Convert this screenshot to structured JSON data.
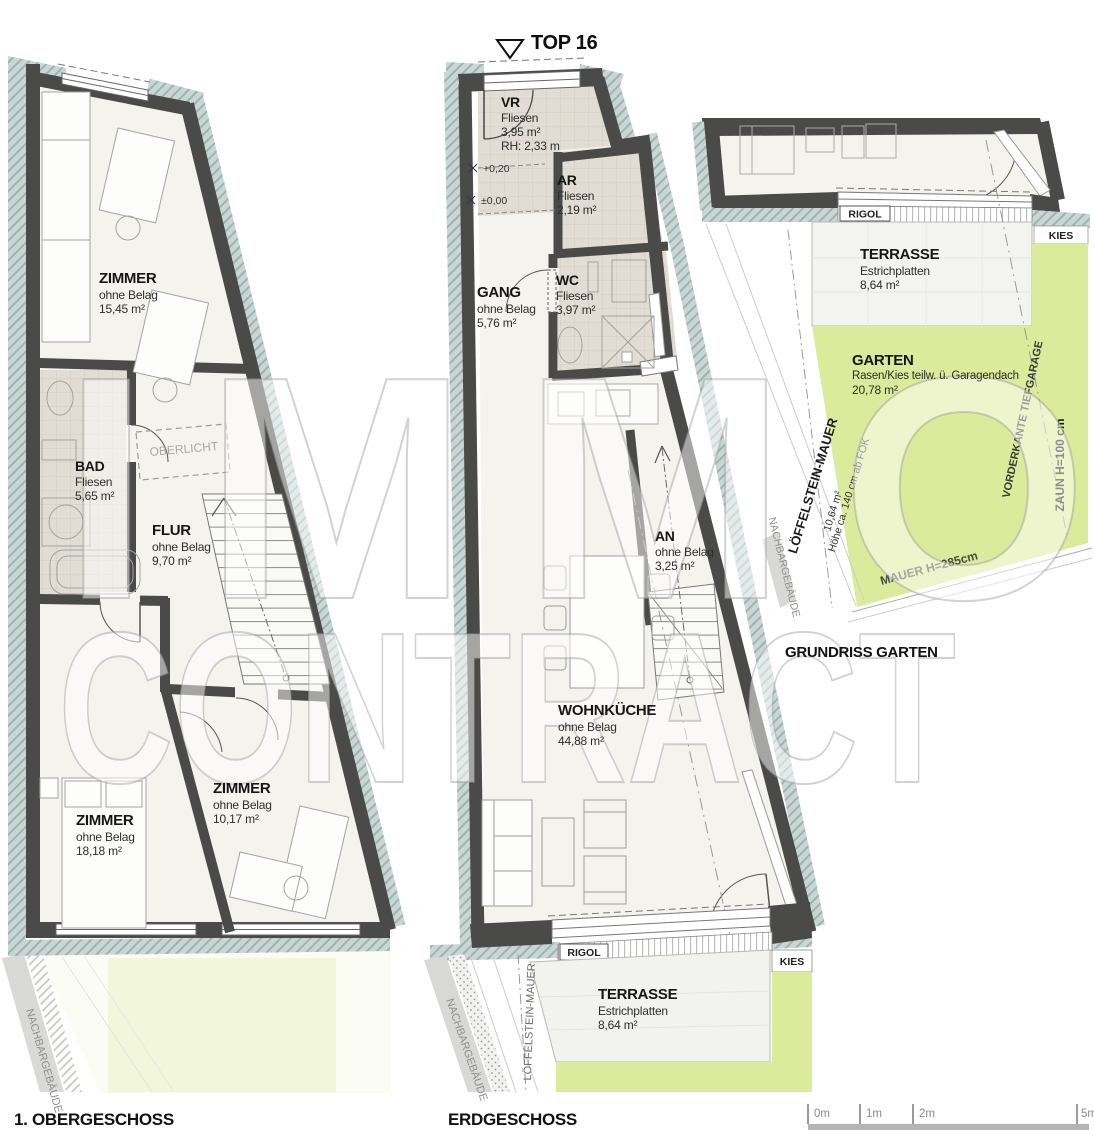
{
  "header": {
    "unit": "TOP 16"
  },
  "watermark": {
    "line1": "IMMO",
    "line2": "CONTRACT"
  },
  "upper": {
    "title": "1. OBERGESCHOSS",
    "zimmer1": {
      "name": "ZIMMER",
      "finish": "ohne Belag",
      "area": "15,45 m²"
    },
    "bad": {
      "name": "BAD",
      "finish": "Fliesen",
      "area": "5,65 m²"
    },
    "flur": {
      "name": "FLUR",
      "finish": "ohne Belag",
      "area": "9,70 m²"
    },
    "zimmer2": {
      "name": "ZIMMER",
      "finish": "ohne Belag",
      "area": "18,18 m²"
    },
    "zimmer3": {
      "name": "ZIMMER",
      "finish": "ohne Belag",
      "area": "10,17 m²"
    },
    "oberlicht": "OBERLICHT",
    "nachbar": "NACHBARGEBÄUDE"
  },
  "ground": {
    "title": "ERDGESCHOSS",
    "vr": {
      "name": "VR",
      "finish": "Fliesen",
      "area": "3,95 m²",
      "rh": "RH: 2,33 m"
    },
    "ar": {
      "name": "AR",
      "finish": "Fliesen",
      "area": "2,19 m²"
    },
    "wc": {
      "name": "WC",
      "finish": "Fliesen",
      "area": "3,97 m²"
    },
    "gang": {
      "name": "GANG",
      "finish": "ohne Belag",
      "area": "5,76 m²"
    },
    "an": {
      "name": "AN",
      "finish": "ohne Belag",
      "area": "3,25 m²"
    },
    "wohnkueche": {
      "name": "WOHNKÜCHE",
      "finish": "ohne Belag",
      "area": "44,88 m²"
    },
    "terrasse": {
      "name": "TERRASSE",
      "finish": "Estrichplatten",
      "area": "8,64 m²"
    },
    "level_entry": "+0,20",
    "level_zero": "±0,00",
    "rigol": "RIGOL",
    "kies": "KIES",
    "nachbar": "NACHBARGEBÄUDE",
    "loeffelstein": "LÖFFELSTEIN-MAUER"
  },
  "garden": {
    "title": "GRUNDRISS GARTEN",
    "terrasse": {
      "name": "TERRASSE",
      "finish": "Estrichplatten",
      "area": "8,64 m²"
    },
    "garten": {
      "name": "GARTEN",
      "finish": "Rasen/Kies teilw. ü. Garagendach",
      "area": "20,78 m²"
    },
    "rigol": "RIGOL",
    "kies": "KIES",
    "loeffelstein": "LÖFFELSTEIN-MAUER",
    "loeffelstein_area": "10,64 m²",
    "loeffelstein_hoehe": "Höhe ca. 140 cm ab FOK",
    "nachbar": "NACHBARGEBÄUDE",
    "tiefgarage": "VORDERKANTE TIEFGARAGE",
    "zaun": "ZAUN H=100 cm",
    "mauer": "MAUER H=285cm"
  },
  "scalebar": {
    "t0": "0m",
    "t1": "1m",
    "t2": "2m",
    "t5": "5m"
  },
  "colors": {
    "wall": "#4a4a49",
    "hatch": "#c9d6d4",
    "tile": "#e2ddd4",
    "green": "#dcea9b",
    "floor": "#f4f3ee",
    "terrace": "#f2f2ee"
  }
}
